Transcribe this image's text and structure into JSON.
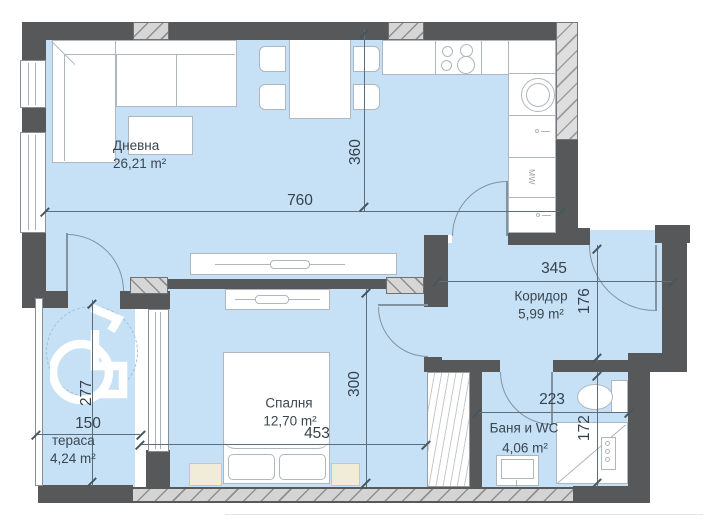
{
  "rooms": {
    "living": {
      "name": "Дневна",
      "area": "26,21 m²"
    },
    "corridor": {
      "name": "Коридор",
      "area": "5,99 m²"
    },
    "bedroom": {
      "name": "Спалня",
      "area": "12,70 m²"
    },
    "bathroom": {
      "name": "Баня и WC",
      "area": "4,06 m²"
    },
    "terrace": {
      "name": "тераса",
      "area": "4,24 m²"
    }
  },
  "dimensions": {
    "living_width": "760",
    "living_depth": "360",
    "corridor_width": "345",
    "corridor_depth": "176",
    "bedroom_width": "453",
    "bedroom_depth": "300",
    "terrace_width": "150",
    "terrace_depth": "277",
    "bathroom_width": "223",
    "bathroom_depth": "172"
  },
  "kitchen": {
    "microwave_label": "MW"
  },
  "colors": {
    "wall": "#57585a",
    "floor": "#c6e0f5",
    "text": "#3a4650"
  }
}
